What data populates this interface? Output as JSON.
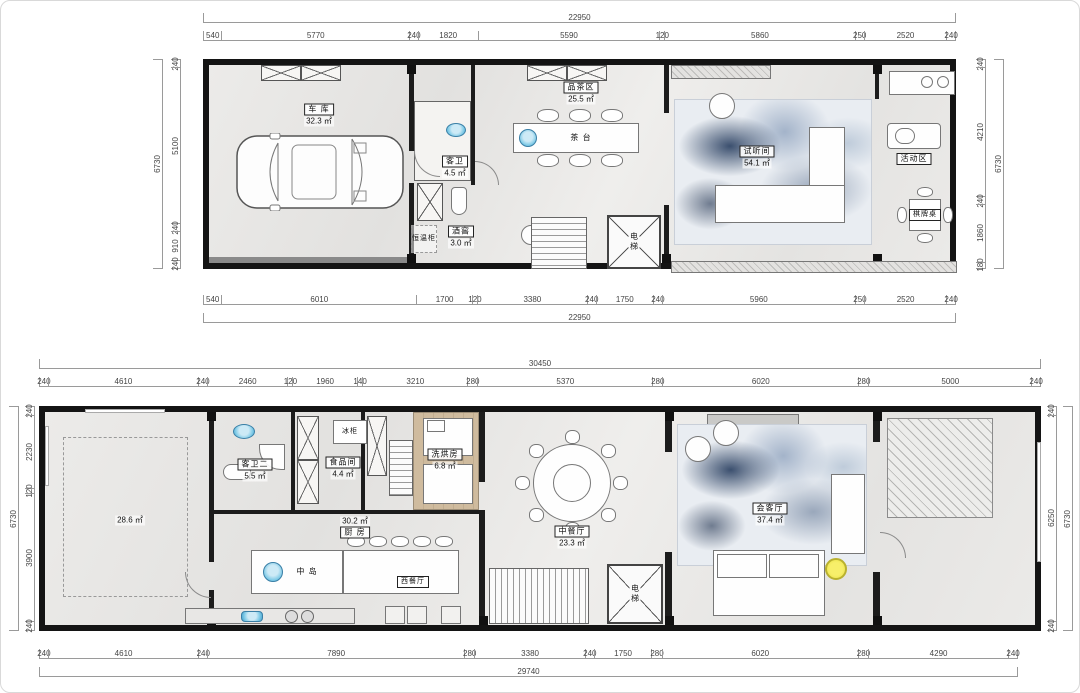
{
  "f1": {
    "dims": {
      "top_total": [
        22950
      ],
      "top": [
        540,
        5770,
        240,
        1820,
        5590,
        120,
        5860,
        250,
        2520,
        240
      ],
      "bottom": [
        540,
        6010,
        1700,
        120,
        3380,
        240,
        1750,
        240,
        5960,
        250,
        2520,
        240
      ],
      "bottom_total": [
        22950
      ],
      "left": [
        240,
        5100,
        240,
        910,
        240
      ],
      "left_total": [
        6730
      ],
      "right": [
        240,
        4210,
        240,
        1860,
        180
      ],
      "right_total": [
        6730
      ]
    },
    "rooms": {
      "garage": {
        "name": "车 库",
        "area": "32.3 ㎡"
      },
      "guest_bath": {
        "name": "客卫",
        "area": "4.5 ㎡"
      },
      "wine": {
        "name": "酒窖",
        "area": "3.0 ㎡"
      },
      "wine_cabinet": {
        "name": "恒温柜"
      },
      "tea": {
        "name": "品茶区",
        "area": "25.5 ㎡"
      },
      "tea_table": {
        "name": "茶 台"
      },
      "av": {
        "name": "试听间",
        "area": "54.1 ㎡"
      },
      "activity": {
        "name": "活动区"
      },
      "chess": {
        "name": "棋牌桌"
      },
      "elevator": {
        "name": "电梯"
      }
    }
  },
  "f2": {
    "dims": {
      "top_total": [
        30450
      ],
      "top": [
        240,
        4610,
        240,
        2460,
        120,
        1960,
        140,
        3210,
        280,
        5370,
        280,
        6020,
        280,
        5000,
        240
      ],
      "bottom": [
        240,
        4610,
        240,
        7890,
        280,
        3380,
        240,
        1750,
        280,
        6020,
        280,
        4290,
        240
      ],
      "bottom_total": [
        29740
      ],
      "left": [
        240,
        2230,
        120,
        3900,
        240
      ],
      "left_total": [
        6730
      ],
      "right": [
        240,
        6250,
        240
      ],
      "right_total": [
        6730
      ]
    },
    "rooms": {
      "multi": {
        "area": "28.6 ㎡"
      },
      "guest_bath2": {
        "name": "客卫二",
        "area": "5.5 ㎡"
      },
      "freezer": {
        "name": "冰柜"
      },
      "pantry": {
        "name": "食品间",
        "area": "4.4 ㎡"
      },
      "laundry": {
        "name": "洗烘房",
        "area": "6.8 ㎡"
      },
      "kitchen": {
        "name": "厨 房",
        "area": "30.2 ㎡"
      },
      "island": {
        "name": "中 岛"
      },
      "west_dining": {
        "name": "西餐厅"
      },
      "cn_dining": {
        "name": "中餐厅",
        "area": "23.3 ㎡"
      },
      "living": {
        "name": "会客厅",
        "area": "37.4 ㎡"
      },
      "elevator": {
        "name": "电梯"
      }
    }
  }
}
